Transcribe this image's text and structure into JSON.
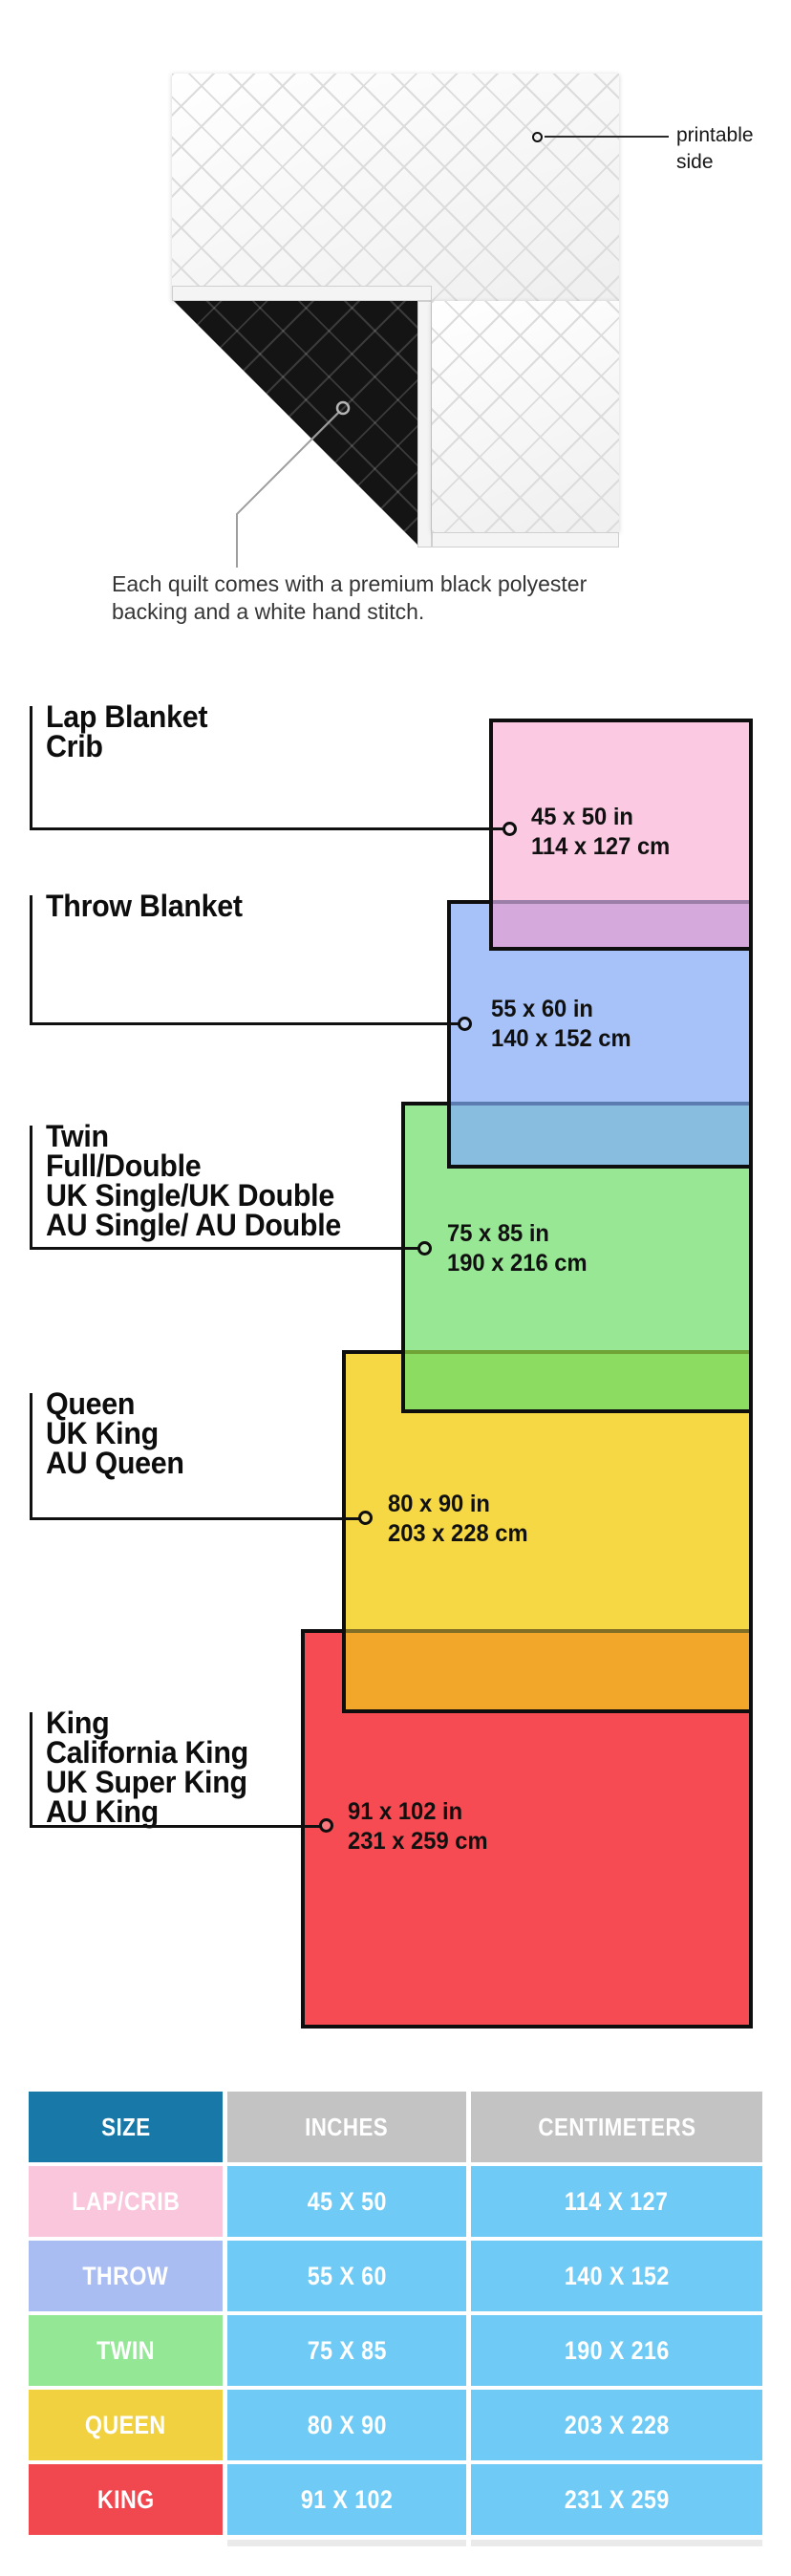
{
  "quilt": {
    "printable_label": {
      "line1": "printable",
      "line2": "side"
    },
    "caption": {
      "line1": "Each quilt comes with a premium black polyester",
      "line2": "backing and a white hand stitch."
    }
  },
  "diagram": {
    "groups": [
      {
        "id": "lap-crib",
        "labels": [
          "Lap Blanket",
          "Crib"
        ],
        "inches": "45 x 50 in",
        "centimeters": "114 x 127 cm",
        "fill": "#FBC9E2",
        "overlap_fill": "#D5A9DC"
      },
      {
        "id": "throw",
        "labels": [
          "Throw Blanket"
        ],
        "inches": "55 x 60 in",
        "centimeters": "140 x 152 cm",
        "fill": "#A6C2F8",
        "overlap_fill": "#88BDE0"
      },
      {
        "id": "twin",
        "labels": [
          "Twin",
          "Full/Double",
          "UK Single/UK Double",
          "AU Single/ AU Double"
        ],
        "inches": "75 x 85 in",
        "centimeters": "190 x 216 cm",
        "fill": "#98E795",
        "overlap_fill": "#8CDC62"
      },
      {
        "id": "queen",
        "labels": [
          "Queen",
          "UK King",
          "AU Queen"
        ],
        "inches": "80 x 90 in",
        "centimeters": "203 x 228 cm",
        "fill": "#F5D844",
        "overlap_fill": "#F2A62A"
      },
      {
        "id": "king",
        "labels": [
          "King",
          "California King",
          "UK Super King",
          "AU King"
        ],
        "inches": "91 x 102 in",
        "centimeters": "231 x 259 cm",
        "fill": "#F64B52",
        "overlap_fill": null
      }
    ]
  },
  "table": {
    "headers": {
      "size": "SIZE",
      "inches": "INCHES",
      "centimeters": "CENTIMETERS"
    },
    "rows": [
      {
        "label": "LAP/CRIB",
        "inches": "45 X 50",
        "centimeters": "114 X 127",
        "label_color": "#F9C6DC"
      },
      {
        "label": "THROW",
        "inches": "55 X 60",
        "centimeters": "140 X 152",
        "label_color": "#A9BDF2"
      },
      {
        "label": "TWIN",
        "inches": "75 X 85",
        "centimeters": "190 X 216",
        "label_color": "#93E795"
      },
      {
        "label": "QUEEN",
        "inches": "80 X 90",
        "centimeters": "203 X 228",
        "label_color": "#F2D141"
      },
      {
        "label": "KING",
        "inches": "91 X 102",
        "centimeters": "231 X 259",
        "label_color": "#F1474E"
      }
    ],
    "colors": {
      "header_size_bg": "#1878A8",
      "header_gray_bg": "#C3C3C3",
      "value_cell_bg": "#6FCBF5"
    }
  }
}
